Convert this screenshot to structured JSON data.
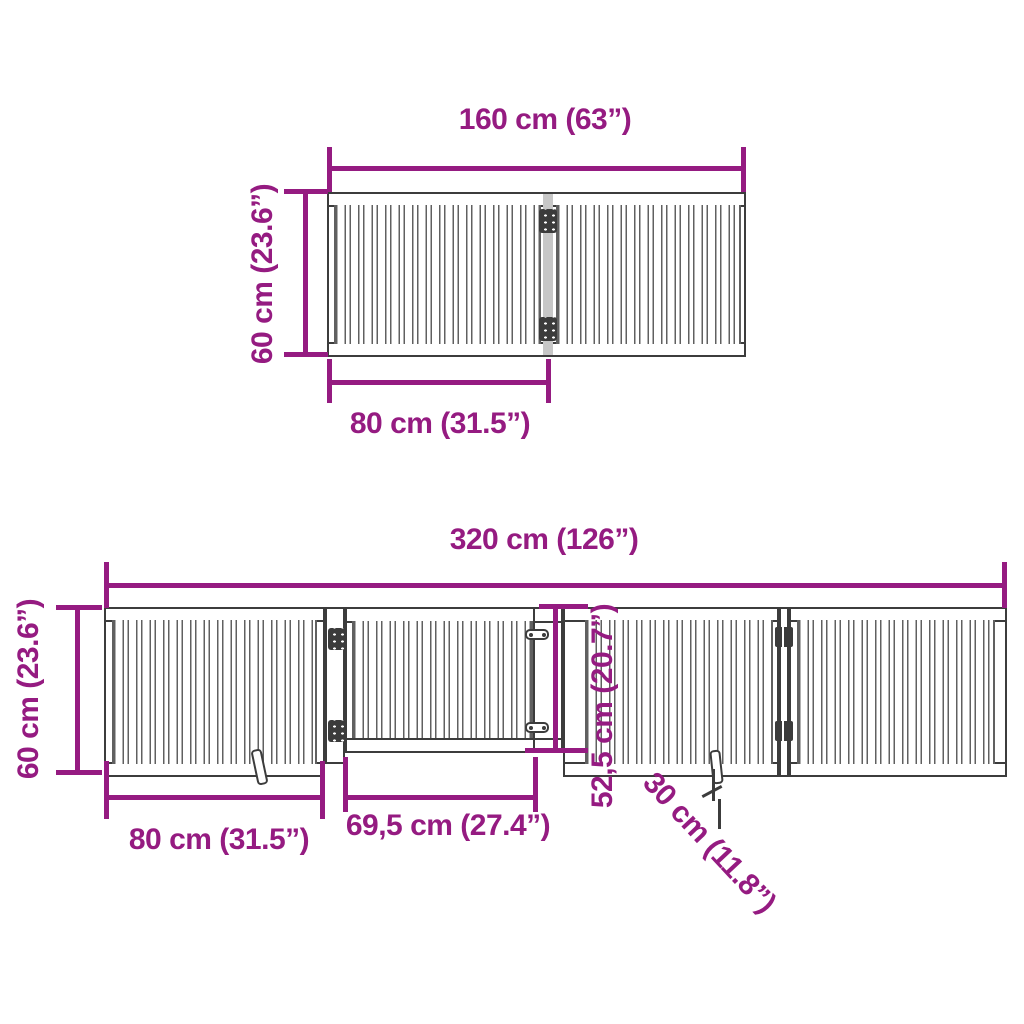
{
  "sheet": {
    "description": "Foldable pet gate dimension diagram, two configurations",
    "background": "#ffffff"
  },
  "colors": {
    "dimension": "#951b81",
    "frame": "#3c3c3c",
    "slat": "#606060",
    "joint": "#c7c7c7",
    "hinge": "#3b3b3b",
    "paper": "#ffffff"
  },
  "top_diagram": {
    "panel_count": 2,
    "total_width_label": "160 cm (63”)",
    "height_label": "60 cm (23.6”)",
    "panel_width_label": "80 cm (31.5”)"
  },
  "bottom_diagram": {
    "panel_count": 4,
    "total_width_label": "320 cm (126”)",
    "height_label": "60 cm (23.6”)",
    "panel_width_label": "80 cm (31.5”)",
    "door_width_label": "69,5 cm (27.4”)",
    "door_height_label": "52,5 cm (20.7”)",
    "foot_depth_label": "30 cm (11.8”)"
  }
}
